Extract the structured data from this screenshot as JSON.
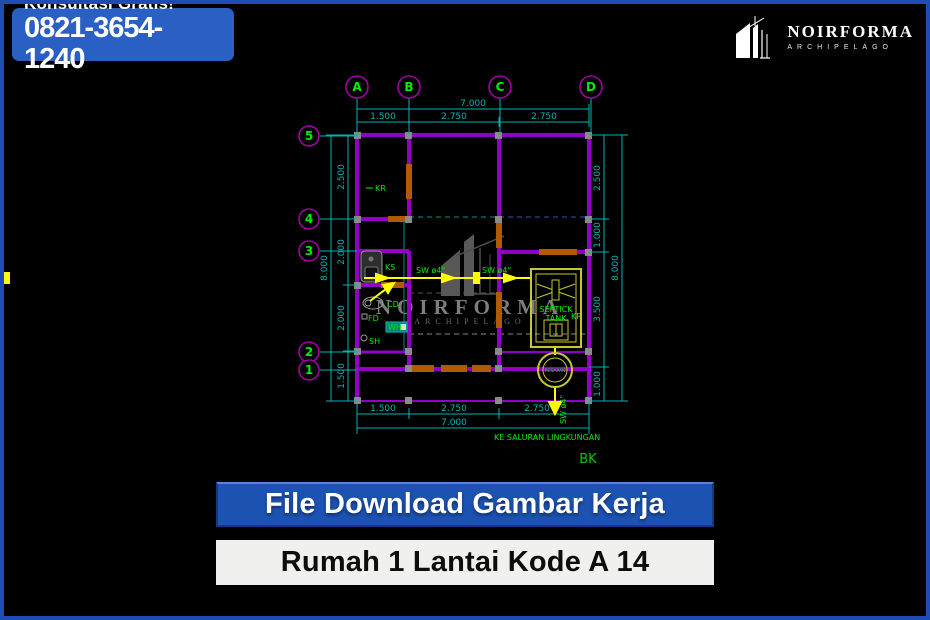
{
  "badge": {
    "line1": "Konsultasi Gratis!",
    "phone": "0821-3654-1240",
    "bg_color": "#2a5fc4"
  },
  "brand": {
    "name": "NOIRFORMA",
    "tagline": "ARCHIPELAGO"
  },
  "watermark": {
    "name": "NOIRFORMA",
    "tagline": "ARCHIPELAGO"
  },
  "banners": {
    "download": "File Download Gambar Kerja",
    "title": "Rumah 1 Lantai Kode A 14",
    "download_bg": "#1c52b2",
    "title_bg": "#f0f0ee"
  },
  "plan": {
    "grid": {
      "columns": [
        "A",
        "B",
        "C",
        "D"
      ],
      "rows": [
        "5",
        "4",
        "3",
        "2",
        "1"
      ]
    },
    "dimensions": {
      "top": {
        "total": "7.000",
        "segments": [
          "1.500",
          "2.750",
          "2.750"
        ]
      },
      "bottom": {
        "total": "7.000",
        "segments": [
          "1.500",
          "2.750",
          "2.750"
        ]
      },
      "left": {
        "total": "8.000",
        "segments": [
          "2.500",
          "2.000",
          "2.000",
          "1.500"
        ]
      },
      "right": {
        "total": "8.000",
        "segments": [
          "2.500",
          "1.000",
          "3.500",
          "1.000"
        ]
      }
    },
    "labels": {
      "kr_left": "KR",
      "ks": "KS",
      "cd": "CD",
      "fd": "FD",
      "wh": "WH",
      "sh": "SH",
      "kr_right": "KR",
      "pipe1": "SW ø4\"",
      "pipe2": "SW ø4\"",
      "pipe3": "SW ø4\"",
      "septic_line1": "SEPTICK",
      "septic_line2": "TANK",
      "resapan": "RESAPAN",
      "outfall": "KE SALURAN LINGKUNGAN",
      "bk": "BK"
    },
    "colors": {
      "wall": "#9000c8",
      "dimension": "#00b4b4",
      "label": "#00ee00",
      "pipe": "#ffff00",
      "door": "#b35900",
      "septic": "#c8c832"
    }
  }
}
